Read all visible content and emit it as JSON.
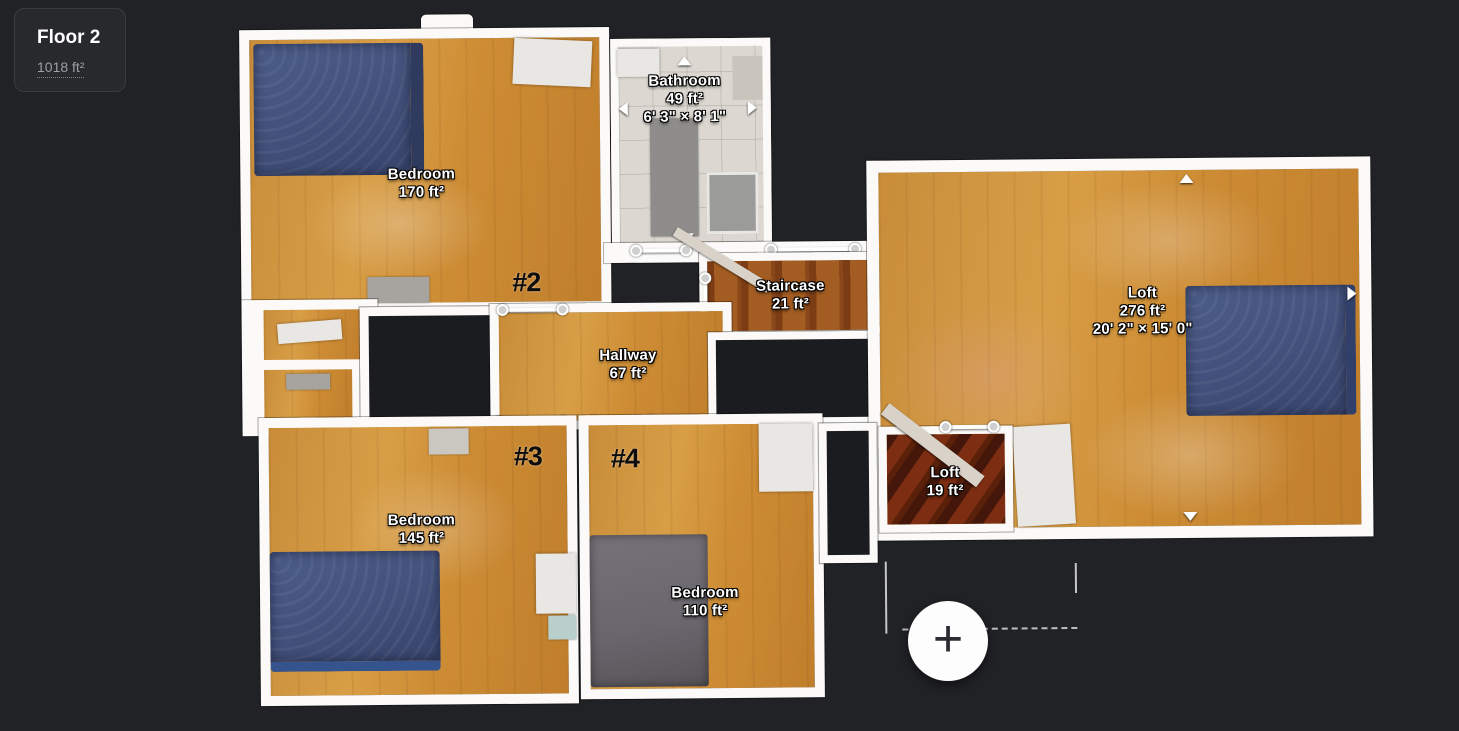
{
  "floor_panel": {
    "title": "Floor 2",
    "area": "1018 ft²"
  },
  "rooms": {
    "bedroom_top": {
      "name": "Bedroom",
      "area": "170 ft²",
      "tag": "#2"
    },
    "bathroom": {
      "name": "Bathroom",
      "area": "49 ft²",
      "dims": "6' 3\" × 8' 1\""
    },
    "staircase": {
      "name": "Staircase",
      "area": "21 ft²"
    },
    "hallway": {
      "name": "Hallway",
      "area": "67 ft²"
    },
    "loft": {
      "name": "Loft",
      "area": "276 ft²",
      "dims": "20' 2\" × 15' 0\""
    },
    "loft_small": {
      "name": "Loft",
      "area": "19 ft²"
    },
    "bedroom_left": {
      "name": "Bedroom",
      "area": "145 ft²",
      "tag": "#3"
    },
    "bedroom_mid": {
      "name": "Bedroom",
      "area": "110 ft²",
      "tag": "#4"
    },
    "door_marker": {
      "tag": "#1"
    }
  },
  "fab": {
    "glyph": "+"
  },
  "colors": {
    "background": "#212226",
    "wall": "#fbfaf8",
    "wood": "#c98d3a",
    "stairs": "#8a4719",
    "mattress_blue": "#42517b",
    "mattress_gray": "#6a666d",
    "panel_bg": "#28292d",
    "label_text": "#ffffff",
    "tag_text": "#0d0d0d"
  }
}
